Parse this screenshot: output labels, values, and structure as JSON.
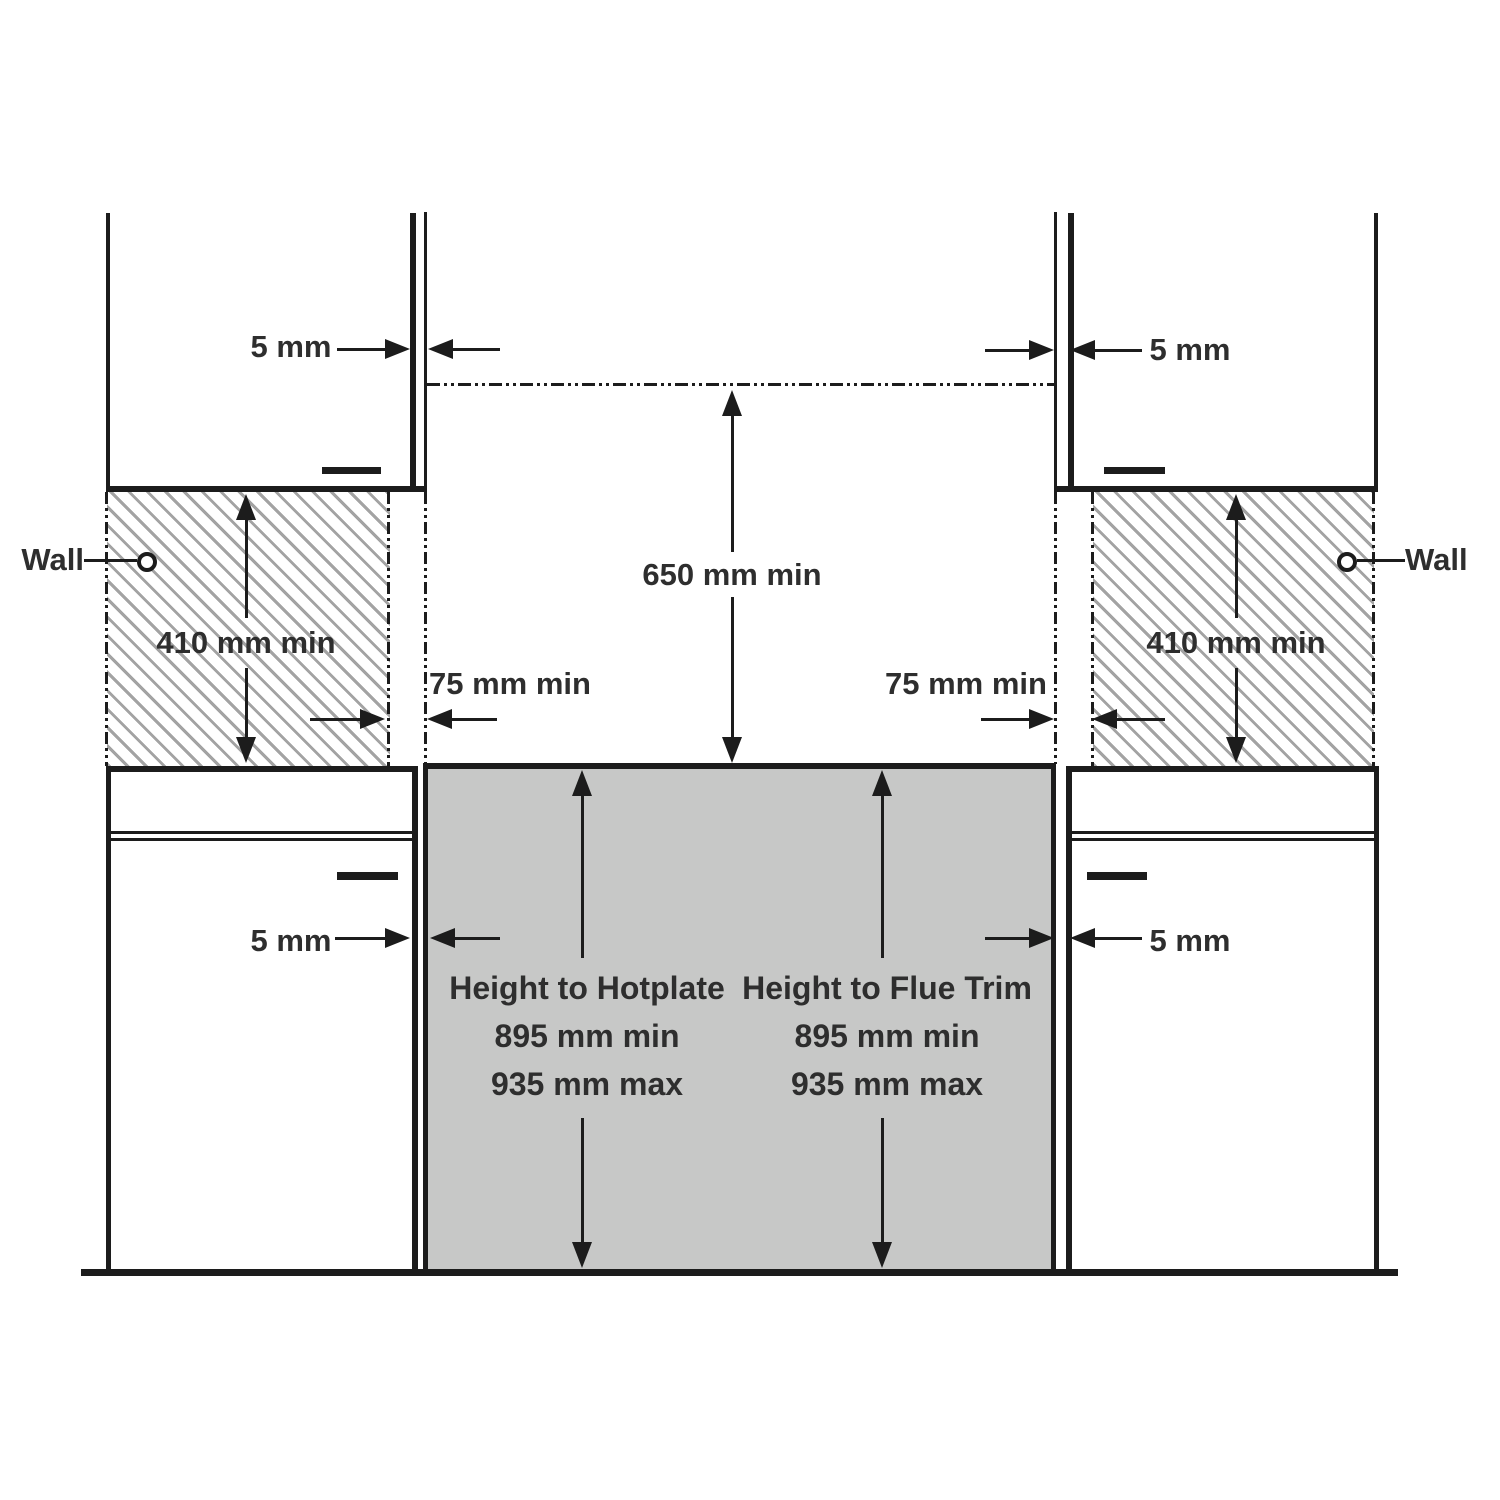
{
  "diagram": {
    "wall_label_left": "Wall",
    "wall_label_right": "Wall",
    "overhead_clearance": "650 mm min",
    "wall_min_height_left": "410 mm min",
    "wall_min_height_right": "410 mm min",
    "side_clearance_left": "75 mm min",
    "side_clearance_right": "75 mm min",
    "cabinet_gap_top_left": "5 mm",
    "cabinet_gap_top_right": "5 mm",
    "cabinet_gap_bottom_left": "5 mm",
    "cabinet_gap_bottom_right": "5 mm",
    "hotplate_height_title": "Height to Hotplate",
    "hotplate_height_min": "895 mm min",
    "hotplate_height_max": "935 mm max",
    "flue_height_title": "Height to Flue Trim",
    "flue_height_min": "895 mm min",
    "flue_height_max": "935 mm max",
    "colors": {
      "line": "#1c1c1c",
      "stove_fill": "#c7c8c7",
      "hatch_stroke": "#a3a3a3",
      "text": "#2e2e2e"
    }
  }
}
